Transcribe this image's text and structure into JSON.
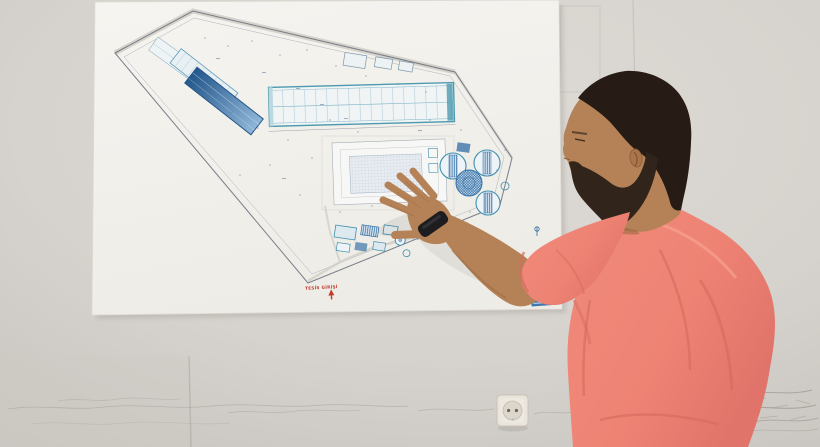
{
  "scene": {
    "description": "A man with dark hair and a beard, wearing a coral polo shirt, points with his left hand at a large printed site plan of an industrial treatment facility taped to a white wall. Faint pencil sketches run along the wall below the plan, next to a round European power socket.",
    "subject": "man pointing at site plan",
    "surface": "white office wall"
  },
  "plan": {
    "drawing_type": "facility site plan",
    "entrance_label": "TESİS GİRİŞİ",
    "features": [
      "perimeter boundary polygon",
      "long hangar building with column grid",
      "sloped blue service buildings",
      "gridded aeration basin",
      "circular clarifier tanks",
      "cross-hatched digester tank",
      "outbuilding cluster",
      "red entrance arrow",
      "blue title stamp"
    ]
  },
  "colors": {
    "wall": "#d8d4cf",
    "wall-shadow": "#c8c4bf",
    "paper": "#f4f2ed",
    "plan-line": "#6b7280",
    "plan-teal": "#4d9ab0",
    "plan-blue": "#2f6da5",
    "plan-blue-deep": "#24578b",
    "plan-red": "#c23b2d",
    "pencil": "#a29c94",
    "outlet-plate": "#eae5dc",
    "shirt": "#ee8374",
    "shirt-shadow": "#d56b5e",
    "shirt-highlight": "#f6a191",
    "skin": "#b58257",
    "skin-shadow": "#96663f",
    "hair": "#261c15",
    "beard": "#31251b",
    "watch": "#1d1c1f"
  }
}
